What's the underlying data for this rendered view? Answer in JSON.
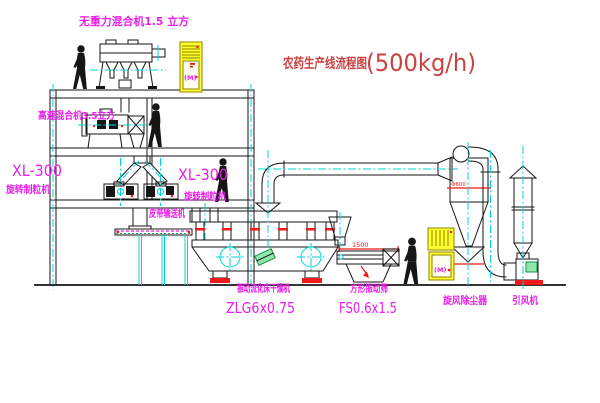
{
  "title": {
    "text": "农药生产线流程图",
    "capacity": "(500kg/h)"
  },
  "equipment": {
    "gravity_mixer": {
      "label": "无重力混合机1.5 立方"
    },
    "high_speed_mixer": {
      "label": "高速混合机3.5立方"
    },
    "granulator_left": {
      "model": "XL-300",
      "name": "旋转制粒机"
    },
    "granulator_right": {
      "model": "XL-300",
      "name": "旋转制粒机"
    },
    "belt_conveyor": {
      "name": "皮带输送机"
    },
    "dryer": {
      "name": "振动流化床干燥机",
      "model": "ZLG6x0.75"
    },
    "sieve": {
      "name": "方形振动筛",
      "model": "FS0.6x1.5",
      "dimension": "1500"
    },
    "cyclone": {
      "name": "旋风除尘器",
      "dimension": "Φ600"
    },
    "fan": {
      "name": "引风机"
    },
    "control_cabinet": {
      "symbol": "(M)"
    }
  },
  "colors": {
    "line": "#161616",
    "centerline": "#00d6d6",
    "label_magenta": "#ea1fea",
    "title_red": "#cc4040",
    "dimension_red": "#f01818",
    "cabinet_yellow": "#ffff2e",
    "accent_green": "#1a8f4d",
    "background": "#ffffff"
  }
}
